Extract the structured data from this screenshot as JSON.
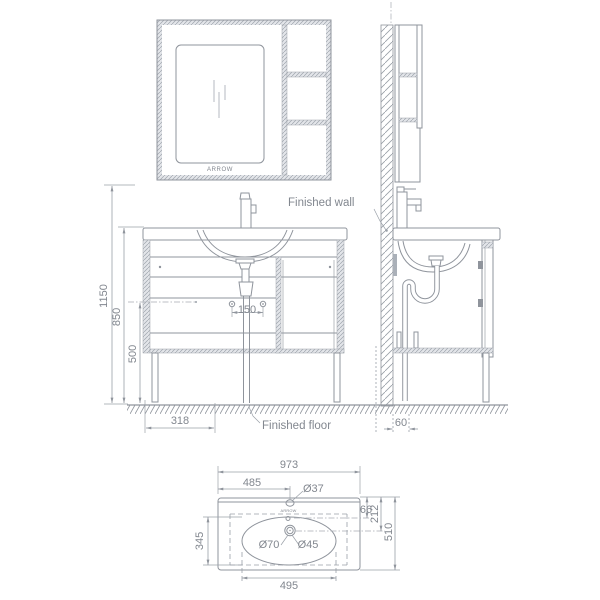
{
  "labels": {
    "finished_wall": "Finished wall",
    "finished_floor": "Finished floor",
    "brand": "ARROW"
  },
  "dims": {
    "front": {
      "total_height": "1150",
      "counter_height": "850",
      "inlet_height": "500",
      "hole_spacing": "150",
      "base_offset": "318"
    },
    "side": {
      "drain_wall_offset": "60"
    },
    "plan": {
      "total_width": "973",
      "faucet_center": "485",
      "faucet_hole": "Ø37",
      "overflow_depth": "66",
      "drain_depth": "212",
      "total_depth": "510",
      "basin_depth": "345",
      "basin_width": "495",
      "drain_outer": "Ø70",
      "drain_inner": "Ø45"
    }
  },
  "colors": {
    "line": "#8f949c",
    "dimension": "#9aa0a8",
    "text": "#82878f",
    "hatch": "#9fa5ad",
    "background": "#ffffff"
  }
}
